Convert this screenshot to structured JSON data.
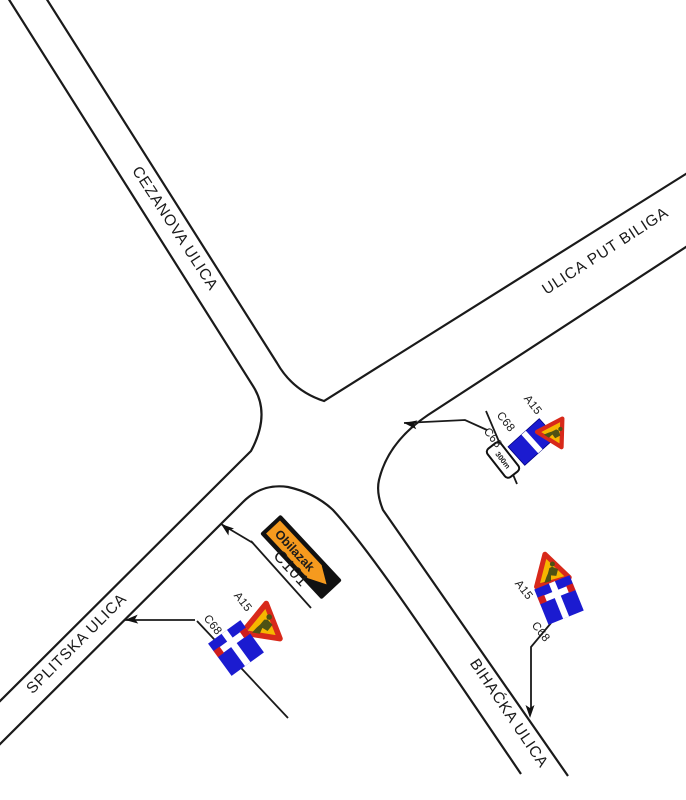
{
  "drawing": {
    "type": "traffic-signalization-plan",
    "background": "#ffffff",
    "line_color": "#1a1a1a"
  },
  "streets": [
    {
      "name": "CEZANOVA ULICA"
    },
    {
      "name": "ULICA PUT BILIGA"
    },
    {
      "name": "SPLITSKA ULICA"
    },
    {
      "name": "BIHAĆKA ULICA"
    }
  ],
  "detour": {
    "sign_text": "Obilazak",
    "code": "C101"
  },
  "assemblies": {
    "put_biliga": {
      "labels": [
        "A15",
        "C68",
        "C68"
      ],
      "distance_plate": "300m"
    },
    "splitska": {
      "labels": [
        "A15",
        "C68"
      ]
    },
    "bihacka": {
      "labels": [
        "A15",
        "C68"
      ]
    }
  },
  "colors": {
    "line": "#1a1a1a",
    "sign_blue": "#1b1bd0",
    "warn_fill": "#f6b600",
    "warn_border": "#d8291a",
    "detour_orange": "#f59a1e",
    "dead_end_red": "#cf1d1d",
    "plate_white": "#ffffff"
  }
}
